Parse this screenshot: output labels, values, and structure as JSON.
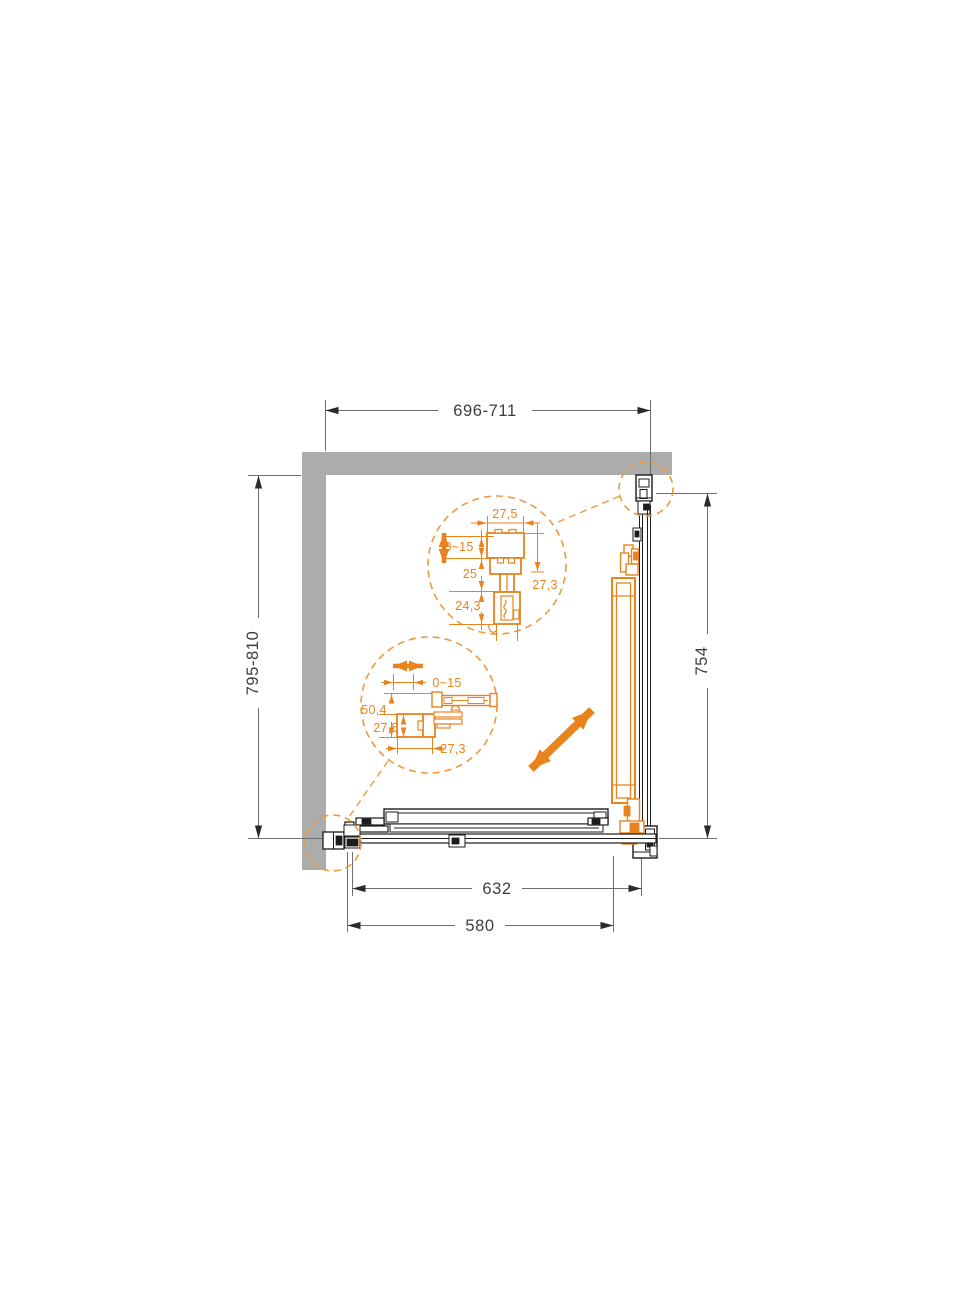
{
  "drawing": {
    "title": "Corner sliding shower enclosure — plan view installation diagram",
    "main_dimensions": {
      "top_width": "696-711",
      "left_depth": "795-810",
      "right_panel_width": "754",
      "rail_length": "632",
      "door_glass_width": "580"
    },
    "top_profile_detail": {
      "profile_width": "27,5",
      "adjustment_range": "0~15",
      "segment_mid": "25",
      "segment_lower": "24,3",
      "profile_depth": "27,3"
    },
    "wall_profile_detail": {
      "adjustment_range": "0~15",
      "overall_depth": "50,4",
      "profile_height": "27,5",
      "profile_width": "27,3"
    },
    "colors": {
      "accent_orange": "#E8831D",
      "dashed_orange": "#EC9A3C",
      "wall_gray": "#ACACAC",
      "line_black": "#1C1C1C",
      "dim_line_gray": "#6E6E6E",
      "dim_text_gray": "#3D3D3D"
    }
  }
}
